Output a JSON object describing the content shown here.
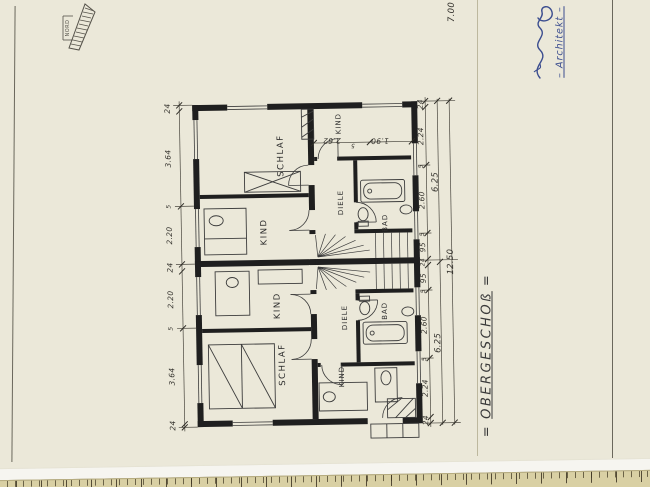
{
  "sheet": {
    "north_label": "NORD",
    "signature_label": "– Architekt –",
    "top_dim": "7.00"
  },
  "plan": {
    "title": "OBERGESCHOß",
    "title_mark_left": "=",
    "title_mark_right": "=",
    "rooms": {
      "schlaf_top": "SCHLAF",
      "kind_mid_top": "KIND",
      "kind_top_right": "KIND",
      "diele_top": "DIELE",
      "bad_top": "BAD",
      "kind_mid_bottom": "KIND",
      "schlaf_bottom": "SCHLAF",
      "diele_bottom": "DIELE",
      "bad_bottom": "BAD",
      "kind_bottom_right": "KIND"
    },
    "dims_left": [
      "24",
      "3.64",
      "5",
      "2.20",
      "24",
      "2.20",
      "5",
      "3.64",
      "24"
    ],
    "dims_right": [
      "24",
      "2.24",
      "5",
      "2.60",
      "5",
      "95",
      "24",
      "95",
      "5",
      "2.60",
      "5",
      "2.24",
      "24"
    ],
    "dims_mid": [
      "6.25",
      "6.25"
    ],
    "dim_total": "12.50",
    "dims_kind_room": [
      "2.62",
      "5",
      "1.90"
    ]
  },
  "ruler": {
    "marks": [
      "3",
      "4",
      "5",
      "6",
      "7",
      "2",
      "3",
      "4",
      "m"
    ]
  }
}
